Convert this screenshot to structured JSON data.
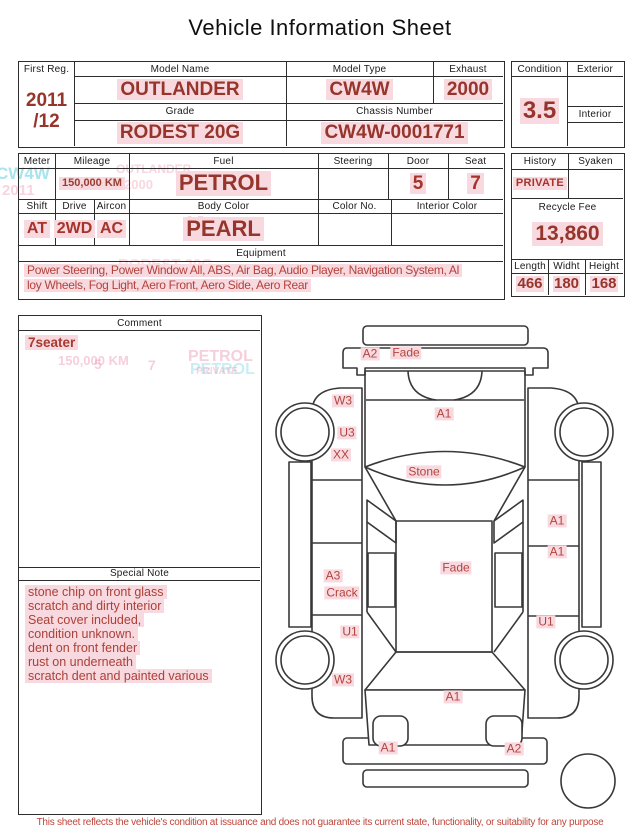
{
  "title": "Vehicle Information Sheet",
  "header_table": {
    "first_reg_label": "First Reg.",
    "first_reg_year": "2011",
    "first_reg_month": "/12",
    "model_name_label": "Model Name",
    "model_name": "OUTLANDER",
    "model_type_label": "Model Type",
    "model_type": "CW4W",
    "exhaust_label": "Exhaust",
    "exhaust": "2000",
    "grade_label": "Grade",
    "grade": "RODEST 20G",
    "chassis_label": "Chassis Number",
    "chassis": "CW4W-0001771"
  },
  "condition_box": {
    "condition_label": "Condition",
    "condition": "3.5",
    "exterior_label": "Exterior",
    "interior_label": "Interior"
  },
  "spec_table": {
    "meter_label": "Meter",
    "mileage_label": "Mileage",
    "mileage": "150,000 KM",
    "fuel_label": "Fuel",
    "fuel": "PETROL",
    "steering_label": "Steering",
    "door_label": "Door",
    "door": "5",
    "seat_label": "Seat",
    "seat": "7",
    "shift_label": "Shift",
    "shift": "AT",
    "drive_label": "Drive",
    "drive": "2WD",
    "aircon_label": "Aircon",
    "aircon": "AC",
    "body_color_label": "Body Color",
    "body_color": "PEARL",
    "color_no_label": "Color No.",
    "interior_color_label": "Interior Color",
    "equipment_label": "Equipment",
    "equipment_line1": "Power Steering, Power Window  All, ABS, Air Bag, Audio Player, Navigation System, Al",
    "equipment_line2": "loy Wheels, Fog Light, Aero Front, Aero Side, Aero Rear"
  },
  "history_box": {
    "history_label": "History",
    "history": "PRIVATE",
    "syaken_label": "Syaken",
    "recycle_fee_label": "Recycle Fee",
    "recycle_fee": "13,860",
    "length_label": "Length",
    "length": "466",
    "width_label": "Widht",
    "width": "180",
    "height_label": "Height",
    "height": "168"
  },
  "comment_box": {
    "comment_label": "Comment",
    "comment": "7seater",
    "special_note_label": "Special Note",
    "special_notes": [
      "stone chip on front glass",
      "scratch and dirty interior",
      "Seat cover included,",
      "condition unknown.",
      "dent on front fender",
      "rust on underneath",
      "scratch dent and painted various"
    ]
  },
  "diagram": {
    "labels": [
      "A2",
      "Fade",
      "W3",
      "A1",
      "U3",
      "XX",
      "Stone",
      "A1",
      "A1",
      "A3",
      "Crack",
      "Fade",
      "U1",
      "U1",
      "W3",
      "A1",
      "A1",
      "A2"
    ]
  },
  "artifacts": [
    "CW4W",
    "2011",
    "OUTLANDER",
    "2000",
    "3.5",
    "RODEST 20G",
    "150,000 KM",
    "PETROL",
    "PETROL",
    "5",
    "7",
    "PRIVATE"
  ],
  "footer": {
    "disclaimer": "This sheet reflects the vehicle's condition at issuance and does not guarantee its current state, functionality, or suitability for any purpose"
  },
  "colors": {
    "value_red": "#96352b",
    "note_red": "#ab4036",
    "highlight_pink": "#f8d9e0",
    "line_dark": "#2d2d2d"
  }
}
